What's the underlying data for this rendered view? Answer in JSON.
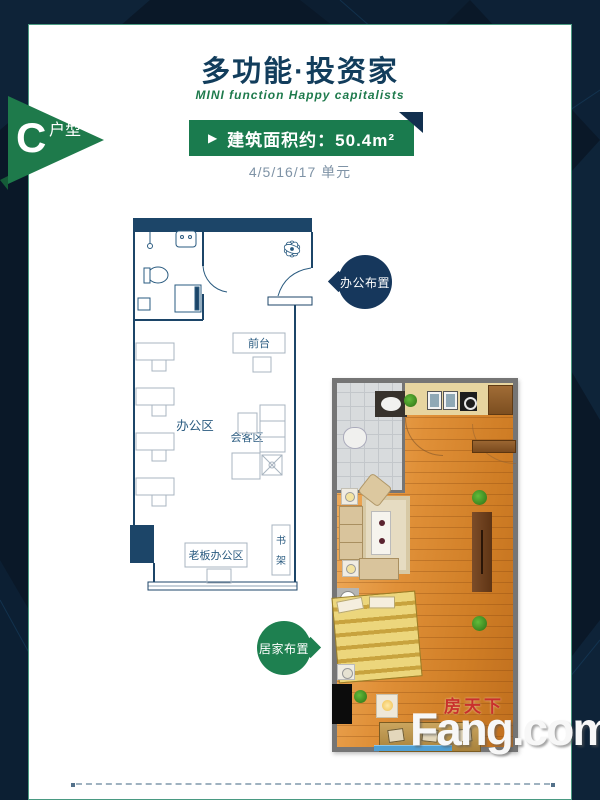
{
  "header": {
    "title": "多功能·投资家",
    "subtitle": "MINI function Happy capitalists",
    "play_icon": "▶",
    "area_label": "建筑面积约：50.4m²",
    "units": "4/5/16/17 单元"
  },
  "flag": {
    "letter": "C",
    "type": "户型"
  },
  "office_plan": {
    "tag": "办公布置",
    "front_desk": "前台",
    "office_area": "办公区",
    "meeting_area": "会客区",
    "boss_office": "老板办公区",
    "bookshelf_top": "书",
    "bookshelf_bottom": "架"
  },
  "home_plan": {
    "tag": "居家布置"
  },
  "watermark": {
    "cn": "房天下",
    "en": "Fang.com"
  },
  "colors": {
    "background": "#0a1828",
    "card": "#ffffff",
    "card_border": "#4a9a82",
    "title": "#123d5c",
    "banner_green": "#1a7b4e",
    "banner_fold": "#12304f",
    "subtitle_green": "#1e7a4c",
    "units_gray": "#7f93a6",
    "plan_wall": "#1c4568",
    "plan_furniture": "#a8b4c0",
    "tag_navy": "#16375c",
    "tag_green": "#1e8050",
    "pennant_green": "#1e7a4b",
    "watermark_red": "#c9302c",
    "wood_floor": "#e09038"
  }
}
